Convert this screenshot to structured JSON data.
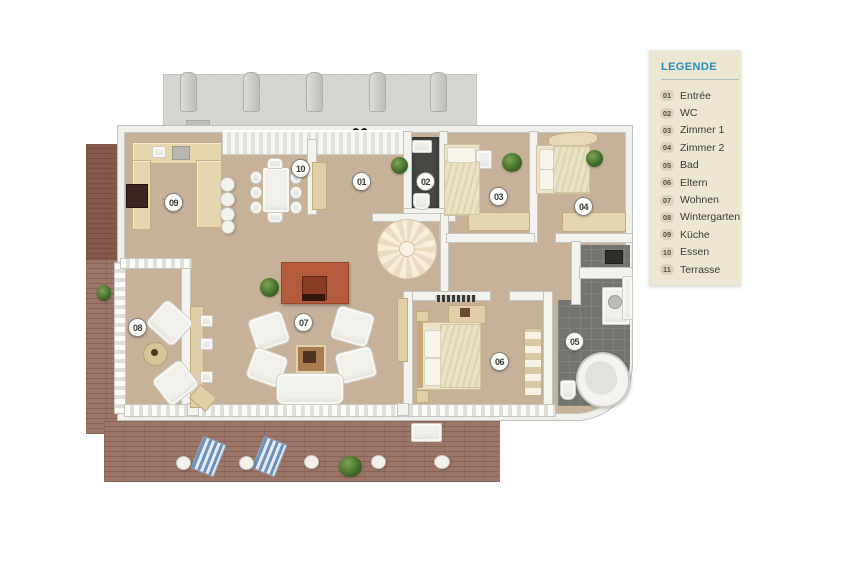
{
  "legend": {
    "title": "LEGENDE",
    "items": [
      {
        "num": "01",
        "label": "Entrée"
      },
      {
        "num": "02",
        "label": "WC"
      },
      {
        "num": "03",
        "label": "Zimmer 1"
      },
      {
        "num": "04",
        "label": "Zimmer 2"
      },
      {
        "num": "05",
        "label": "Bad"
      },
      {
        "num": "06",
        "label": "Eltern"
      },
      {
        "num": "07",
        "label": "Wohnen"
      },
      {
        "num": "08",
        "label": "Wintergarten"
      },
      {
        "num": "09",
        "label": "Küche"
      },
      {
        "num": "10",
        "label": "Essen"
      },
      {
        "num": "11",
        "label": "Terrasse"
      }
    ]
  },
  "plan": {
    "type": "3d-floor-plan",
    "badges": [
      {
        "num": "01",
        "room": "Entrée"
      },
      {
        "num": "02",
        "room": "WC"
      },
      {
        "num": "03",
        "room": "Zimmer 1"
      },
      {
        "num": "04",
        "room": "Zimmer 2"
      },
      {
        "num": "05",
        "room": "Bad"
      },
      {
        "num": "06",
        "room": "Eltern"
      },
      {
        "num": "07",
        "room": "Wohnen"
      },
      {
        "num": "08",
        "room": "Wintergarten"
      },
      {
        "num": "09",
        "room": "Küche"
      },
      {
        "num": "10",
        "room": "Essen"
      }
    ]
  },
  "colors": {
    "legend_bg": "#ece7d3",
    "legend_title": "#2a8cb5",
    "floor_tan": "#c8b199",
    "wall_white": "#f2f2ef",
    "terrace_brick": "#9c7668",
    "balcony_gray": "#d3d3d0",
    "bath_tile": "#74746f",
    "wc_floor": "#474744",
    "fireplace": "#b45b3b"
  }
}
